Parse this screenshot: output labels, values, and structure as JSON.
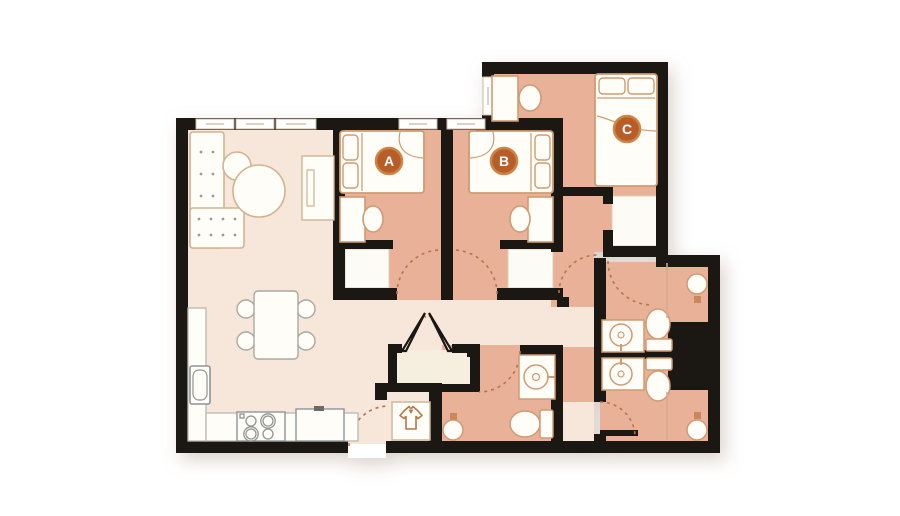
{
  "plan": {
    "title": "Three-bedroom apartment floor plan",
    "rooms": [
      {
        "label": "A",
        "type": "bedroom"
      },
      {
        "label": "B",
        "type": "bedroom"
      },
      {
        "label": "C",
        "type": "bedroom"
      }
    ],
    "fixtures": [
      "sectional-sofa",
      "nesting-coffee-tables",
      "tv-console",
      "dining-table-4-chairs",
      "kitchen-counter",
      "kitchen-sink",
      "stove-4-burners",
      "refrigerator",
      "bed-a",
      "desk-a",
      "chair-a",
      "closet-a",
      "bed-b",
      "desk-b",
      "chair-b",
      "closet-b",
      "bed-c",
      "desk-c",
      "chair-c",
      "closet-c",
      "bathroom-sink-x3",
      "toilet-x3",
      "shower-x3",
      "laundry-wardrobe-closet",
      "double-door-closet",
      "entry-door",
      "utility-chase"
    ],
    "colors": {
      "wall": "#1b1713",
      "floor_light": "#f6e7da",
      "floor_salmon": "#e8b198",
      "closet_white": "#fdfbf6",
      "badge": "#b85c28",
      "badge_ring": "#cd8448",
      "furniture_outline": "#cf9b72",
      "appliance_outline": "#a9a9a0",
      "door_arc": "#b5754a",
      "accent_dot": "#c9885c"
    }
  }
}
